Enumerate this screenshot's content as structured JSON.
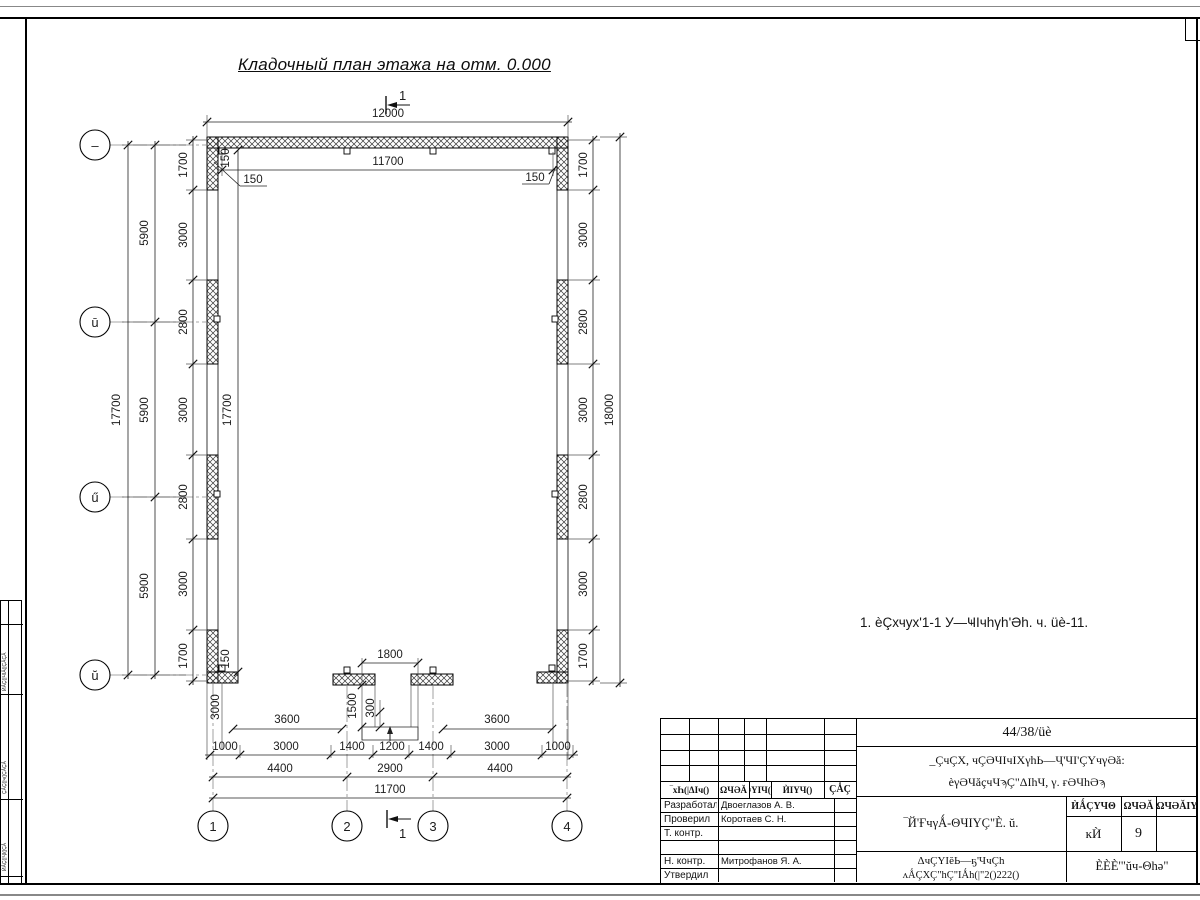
{
  "page": {
    "title": "Кладочный план этажа на отм. 0.000",
    "note": "1. èÇхчух'1-1 У—ҸΙчhγh'Әh. ч. üè-11.",
    "section_label": "1"
  },
  "axes": {
    "left": [
      "–",
      "ū",
      "ű",
      "ŭ"
    ],
    "bottom": [
      "1",
      "2",
      "3",
      "4"
    ]
  },
  "dims": {
    "top": {
      "overall": "12000",
      "inner": "11700",
      "t150v": "150",
      "t150l": "150",
      "t150r": "150"
    },
    "left": {
      "total": "17700",
      "axis": [
        "5900",
        "5900",
        "5900"
      ],
      "chain": [
        "1700",
        "3000",
        "2800",
        "3000",
        "2800",
        "3000",
        "1700"
      ],
      "inner_total": "17700",
      "b150": "150"
    },
    "right": {
      "chain": [
        "1700",
        "3000",
        "2800",
        "3000",
        "2800",
        "3000",
        "1700"
      ],
      "total": "18000"
    },
    "bottom": {
      "stub": "3000",
      "d1800": "1800",
      "d1500": "1500",
      "d300": "300",
      "d3600a": "3600",
      "d3600b": "3600",
      "chain": [
        "1000",
        "3000",
        "1400",
        "1200",
        "1400",
        "3000",
        "1000"
      ],
      "chain2": [
        "4400",
        "2900",
        "4400"
      ],
      "total": "11700"
    }
  },
  "titleblock": {
    "doc_number": "44/38/üè",
    "project_line1": "_ÇчÇХ, чÇӘЧΙчΙХγhЬ—Ҷ'ЧΙ'ÇΥчγӘă:",
    "project_line2": "èγӘЧăçчЧϡÇ\"ΔΙhЧ, γ. ғӘЧhӘϡ",
    "sheet_title": "‾Й'ҒчγǺ-ΘЧΙΥÇ\"È. ŭ.",
    "col_headers": [
      "‾хҺ(|ΔΙч()",
      "ΩЧӘĂ",
      "≈ΥΙЧ()",
      "ЍΙΥЧ()",
      "ÇǺÇ"
    ],
    "rows": [
      {
        "role": "Разработал",
        "name": "Двоеглазов А. В."
      },
      {
        "role": "Проверил",
        "name": "Коротаев С. Н."
      },
      {
        "role": "Т. контр.",
        "name": ""
      },
      {
        "role": "",
        "name": ""
      },
      {
        "role": "Н. контр.",
        "name": "Митрофанов Я. А."
      },
      {
        "role": "Утвердил",
        "name": ""
      }
    ],
    "stage_header": "ЍǺÇΥЧΘ",
    "sheet_header": "ΩЧӘĂ",
    "sheets_header": "ΩЧӘĂΙΥ",
    "stage_value": "ĸЍ",
    "sheet_value": "9",
    "sheets_value": "",
    "org_line1": "ΔчÇΥΙĕЬ—ҕ'ЧчÇh",
    "org_line2": "ʌǺÇХÇ\"hÇ\"ΙǺh(|\"2()222()",
    "firm": "ÈÈÈ'\"ŭч-Θhә\""
  },
  "left_margin": {
    "labels": [
      "ЍǺÇ(|ЧΙǺ(|ÇǺÇǺ",
      "ÇǺÇ(|ч(|ÇǺÇǺ",
      "ЍǺÇ(|ҶΙ(|ÇǺ"
    ]
  }
}
